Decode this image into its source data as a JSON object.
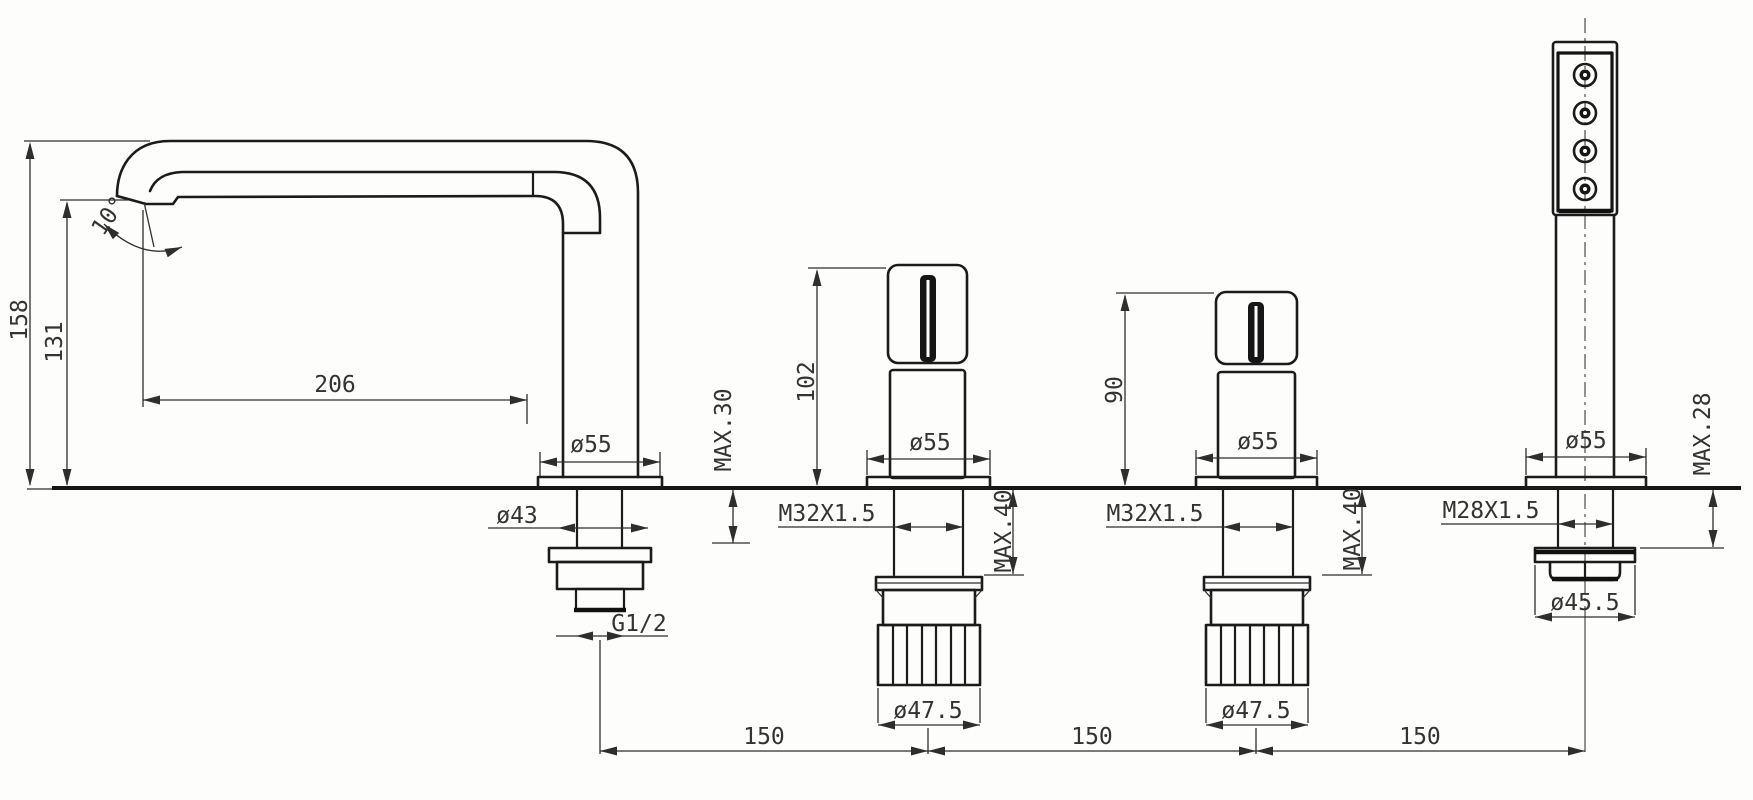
{
  "drawing": {
    "kind": "technical dimensional drawing",
    "subject": "4-hole deck-mounted bathtub mixer: swivel spout, two valve handles, pull-out hand shower",
    "units": "mm",
    "components": {
      "spout": {
        "height": "158",
        "outlet_height": "131",
        "outlet_angle": "10°",
        "reach": "206",
        "base_diameter": "ø55",
        "shank_diameter": "ø43",
        "max_deck_thickness": "MAX.30",
        "connection_thread": "G1/2"
      },
      "left_handle": {
        "height": "102",
        "base_diameter": "ø55",
        "thread": "M32X1.5",
        "max_deck_thickness": "MAX.40",
        "nut_diameter": "ø47.5"
      },
      "right_handle": {
        "height": "90",
        "base_diameter": "ø55",
        "thread": "M32X1.5",
        "max_deck_thickness": "MAX.40",
        "nut_diameter": "ø47.5"
      },
      "hand_shower": {
        "base_diameter": "ø55",
        "thread": "M28X1.5",
        "max_deck_thickness": "MAX.28",
        "nut_diameter": "ø45.5"
      },
      "hole_spacing": [
        "150",
        "150",
        "150"
      ]
    }
  }
}
